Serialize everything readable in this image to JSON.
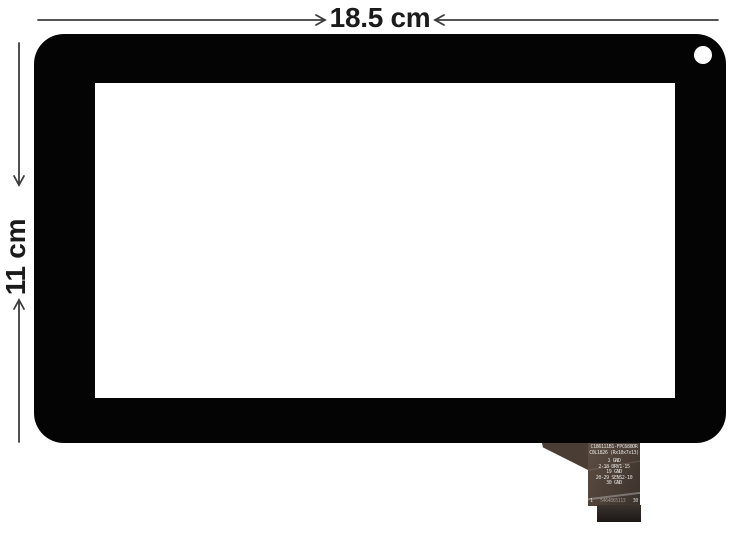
{
  "annotations": {
    "width_label": "18.5 cm",
    "height_label": "11 cm",
    "line_color": "#3d3d3d",
    "text_color": "#1b1b1b"
  },
  "panel": {
    "frame_color": "#040404",
    "screen_color": "#ffffff"
  },
  "cable": {
    "model": "C186111B1-FPC680DR",
    "spec": "C0L1826 (Rx10x7x13)",
    "pins": [
      "1 GND",
      "2-18 DRV1-15",
      "19 GND",
      "20-29 SENS2-10",
      "30 GND"
    ],
    "pin_start": "1",
    "pin_end": "30",
    "serial": "5464865113"
  }
}
